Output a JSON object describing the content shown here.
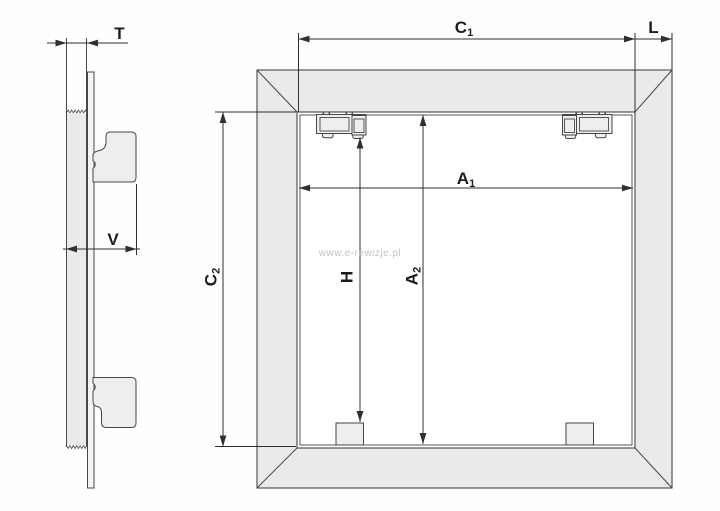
{
  "colors": {
    "line": "#474747",
    "dim_line": "#2f2f2f",
    "frame_fill": "#e9eaea",
    "part_fill": "#eeeeef",
    "panel_fill": "#f4f4f4",
    "label": "#1c1c1c",
    "watermark": "#c3c3c3",
    "background": "#fefefe"
  },
  "side_view": {
    "labels": {
      "T": {
        "base": "T",
        "sub": ""
      },
      "V": {
        "base": "V",
        "sub": ""
      }
    }
  },
  "front_view": {
    "labels": {
      "C1": {
        "base": "C",
        "sub": "1"
      },
      "L": {
        "base": "L",
        "sub": ""
      },
      "C2": {
        "base": "C",
        "sub": "2"
      },
      "A1": {
        "base": "A",
        "sub": "1"
      },
      "A2": {
        "base": "A",
        "sub": "2"
      },
      "H": {
        "base": "H",
        "sub": ""
      }
    },
    "watermark": "www.e-rewizje.pl"
  }
}
